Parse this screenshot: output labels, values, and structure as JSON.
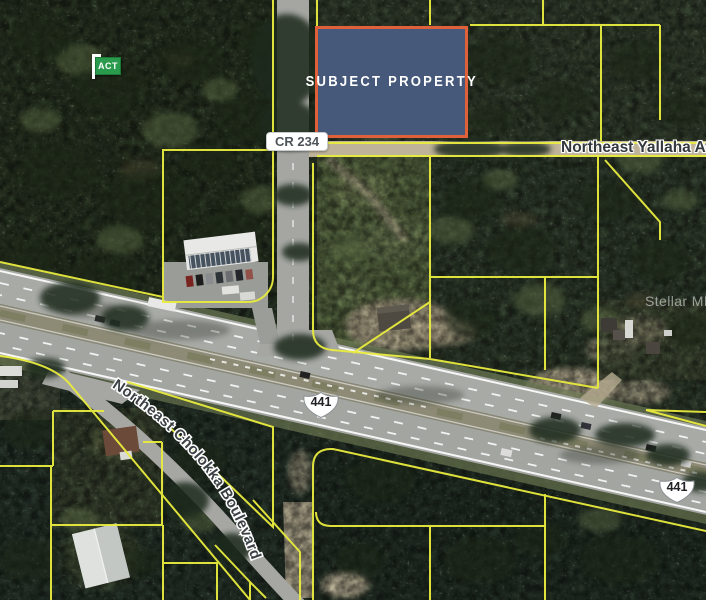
{
  "map": {
    "subject_label": "SUBJECT PROPERTY",
    "road_badges": {
      "cr234": "CR 234"
    },
    "road_labels": {
      "yallaha": "Northeast Yallaha Avenue",
      "cholokka": "Northeast Cholokka Boulevard"
    },
    "route_shields": [
      {
        "id": "shield-441-west",
        "label": "441"
      },
      {
        "id": "shield-441-east",
        "label": "441"
      }
    ],
    "listing_marker": {
      "label": "ACT"
    },
    "watermark": "Stellar MLS",
    "colors": {
      "parcel_line": "#e9ec3e",
      "subject_fill": "#47597a",
      "subject_border": "#e0603a",
      "marker_green": "#2a9a4c"
    }
  }
}
